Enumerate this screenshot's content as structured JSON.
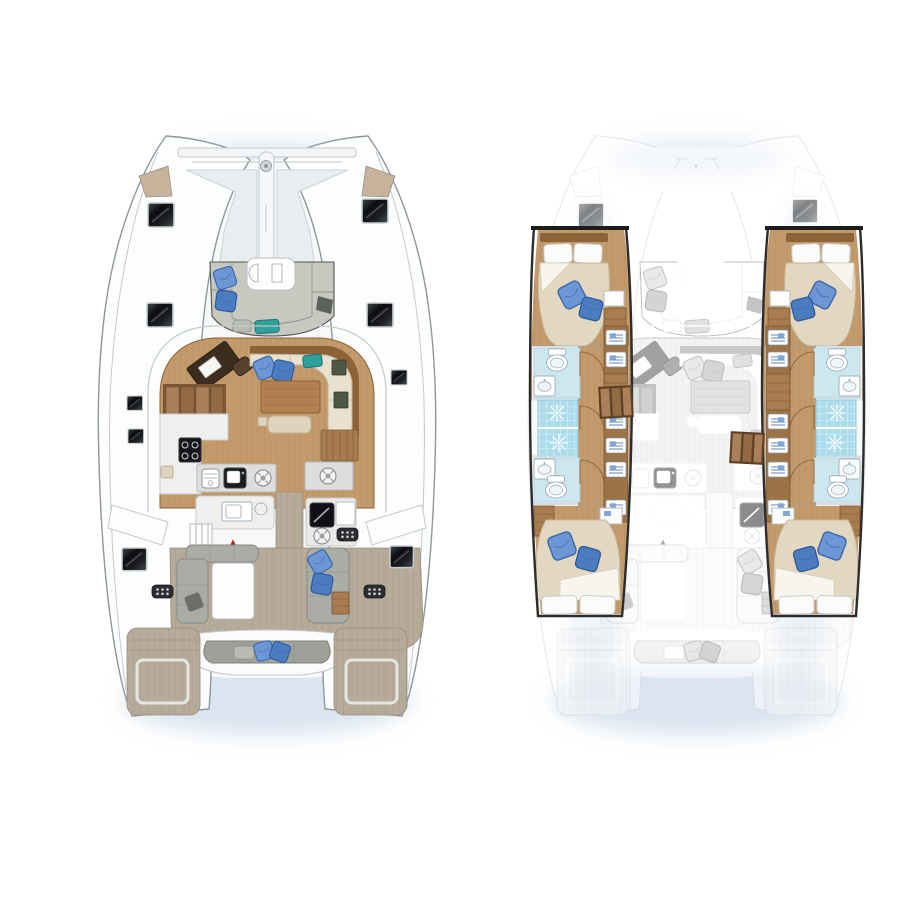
{
  "document": {
    "type": "catamaran-yacht-floorplan",
    "views": [
      {
        "id": "deck-plan",
        "name": "main-deck-layout"
      },
      {
        "id": "hull-plan",
        "name": "cabin-accommodation-layout"
      }
    ]
  },
  "colors": {
    "glow": "#c3d3e6",
    "stern_shadow": "#dbe5f1",
    "hull_fill": "#fcfdfd",
    "hull_line": "#8f969d",
    "rail_line": "#c3c9cf",
    "deck_white": "#f7f8f8",
    "tramp": "#e9edf0",
    "wood_floor": "#c39a6b",
    "wood_plank_line": "#ac825a",
    "wood_trim": "#8c6236",
    "wood_mid": "#a87c4f",
    "nav_desk": "#3c2d1e",
    "cream": "#e9e1cd",
    "cream_line": "#c1b499",
    "beige_duvet": "#e2d7c0",
    "blue_pillow": "#6d97d4",
    "blue_pillow_dark": "#3c68ad",
    "blue_pillow2": "#4c7cc0",
    "teal": "#2fa09a",
    "sofa_gray": "#c7c8c0",
    "sofa_line": "#51564f",
    "out_gray": "#a9ada6",
    "out_gray_dark": "#878b84",
    "teak": "#b6aa99",
    "teak_line": "#a29583",
    "counter_gray": "#dcdedd",
    "counter_line": "#b5b9bb",
    "fixture_line": "#9fb0ba",
    "bath_floor": "#cde7f1",
    "tile": "#aadcec",
    "red_arrow": "#a02a1e"
  },
  "icons": [
    "deck-hatch",
    "cooktop-burners",
    "galley-sink",
    "hob-burner",
    "vent-grille",
    "shower-drain",
    "toilet",
    "washbasin",
    "door-swing",
    "wardrobe-shelf",
    "blue-pillow",
    "teal-cushion"
  ],
  "deck_plan": {
    "features": [
      "bow-trampoline",
      "bowsprit",
      "anchor-lockers",
      "forward-cockpit-lounge",
      "saloon",
      "navigation-station",
      "port-companionway-stairs",
      "galley",
      "dining-sofa",
      "dining-table",
      "sliding-door",
      "cockpit",
      "outdoor-galley",
      "cockpit-table",
      "cockpit-lounges",
      "aft-bench",
      "swim-platforms",
      "deck-hatches"
    ]
  },
  "hull_plan": {
    "port_hull": [
      "forward-cabin",
      "forward-bathroom",
      "shower",
      "wardrobes",
      "companionway-steps",
      "aft-bathroom",
      "aft-cabin"
    ],
    "starboard_hull": [
      "forward-cabin",
      "forward-bathroom",
      "shower",
      "wardrobes",
      "companionway-steps",
      "aft-bathroom",
      "aft-cabin"
    ],
    "ghosted": "main-deck-outline"
  }
}
